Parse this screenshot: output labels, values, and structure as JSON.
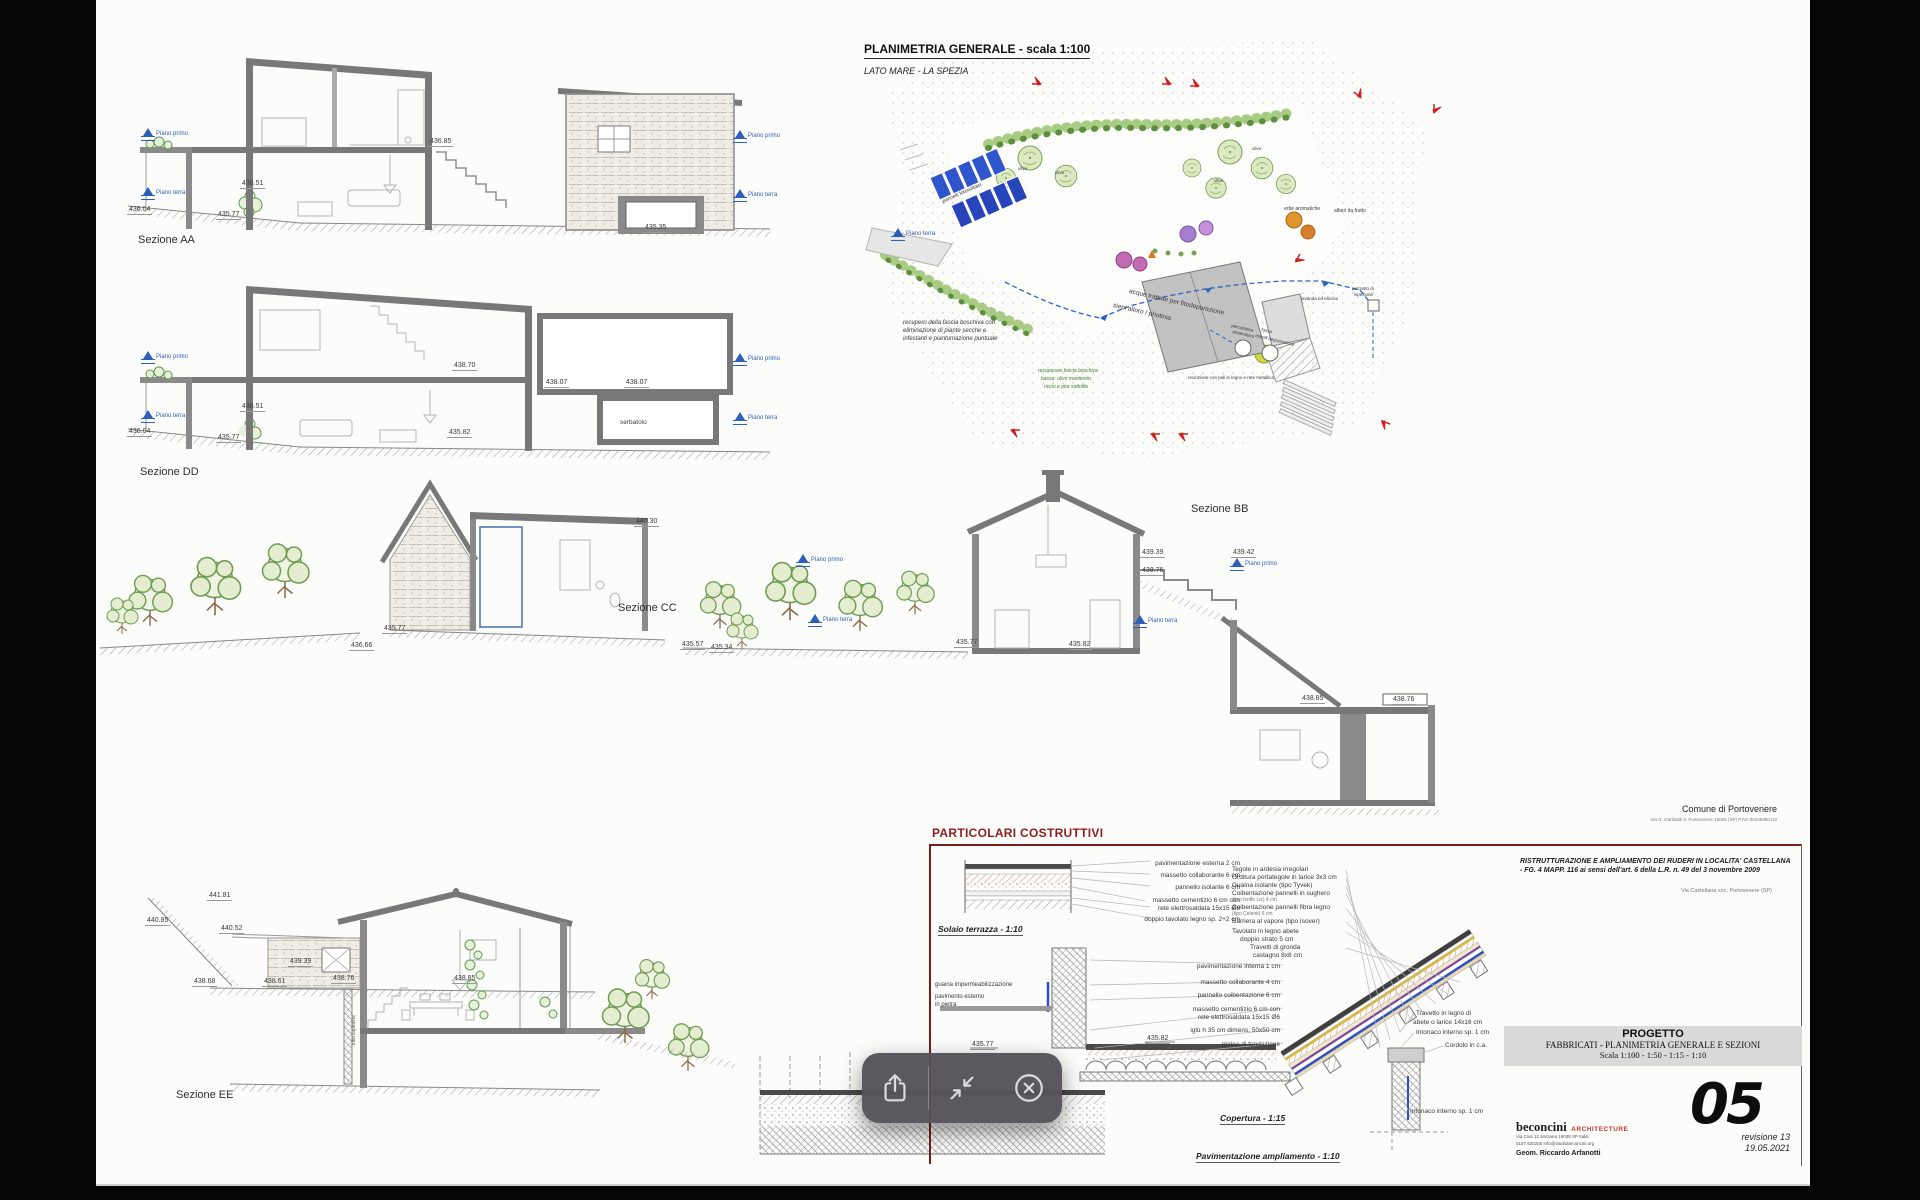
{
  "plan": {
    "title": "PLANIMETRIA GENERALE - scala 1:100",
    "subtitle": "LATO MARE - LA SPEZIA",
    "pannelli": "pannelli fotovoltaici",
    "acque": "acque trattate per fitodepurazione",
    "siepi": "siepi alloro / photinia",
    "ulivo": "ulivo",
    "lavanda": "lavanda ed elicriso",
    "erbe": "erbe aromatiche",
    "alberi": "alberi da frutto",
    "pozzetto1": "pozzetto di",
    "pozzetto2": "ispezione",
    "percolatore1": "percolatore",
    "percolatore2": "anaerobico",
    "fossa1": "fossa",
    "fossa2": "imhoff degrassatore",
    "recupero1": "recupero della fascia boschiva con",
    "recupero2": "eliminazione di piante secche e",
    "recupero3": "infestanti e piantumazione puntuale",
    "recuperare1": "recuperare fascia boschiva",
    "recuperare2": "bassa: ulivo mantenim.",
    "recuperare3": "riccio e pira sottofile",
    "recinzione": "recinzione con pali in legno e rete metallica"
  },
  "common": {
    "piano_primo": "Piano primo",
    "piano_terra": "Piano terra"
  },
  "aa": {
    "label": "Sezione AA",
    "e1": "436.85",
    "e2": "436.51",
    "e3": "436.04",
    "e4": "435.77",
    "e5": "435.35"
  },
  "dd": {
    "label": "Sezione DD",
    "e1": "438.70",
    "e2": "438.07",
    "e3": "438.07",
    "e4": "436.51",
    "e5": "436.04",
    "e6": "435.77",
    "e7": "435.82",
    "serbatoio": "serbatoio"
  },
  "cc": {
    "label": "Sezione CC",
    "e1": "440.30",
    "e2": "435.77",
    "e3": "436.66"
  },
  "bb": {
    "label": "Sezione BB",
    "e1": "439.39",
    "e2": "439.42",
    "e3": "438.76",
    "e4": "435.57",
    "e5": "435.34",
    "e6": "435.77",
    "e7": "435.82",
    "e8": "438.85",
    "e9": "438.76"
  },
  "ee": {
    "label": "Sezione EE",
    "e1": "441.81",
    "e2": "440.85",
    "e3": "440.52",
    "e4": "439.39",
    "e5": "438.68",
    "e6": "438.61",
    "e7": "438.76",
    "e8": "438.85",
    "intercapedine": "Intercapedine"
  },
  "details": {
    "title": "PARTICOLARI COSTRUTTIVI",
    "solaio_caption": "Solaio terrazza - 1:10",
    "s1": "pavimentazione esterna 2 cm",
    "s2": "massetto collaborante 6 cm",
    "s3": "pannello isolante 6 cm",
    "s4": "massetto cementizio 6 cm con",
    "s5": "rete elettrosaldata 15x15 Ø6",
    "s6": "doppio tavolato legno sp. 2+2 cm",
    "f1": "pavimentazione interna 1 cm",
    "f2": "massetto collaborante 4 cm",
    "f3": "pannello coibentazione 6 cm",
    "f4": "massetto cementizio 6 cm con",
    "f5": "rete elettrosaldata 15x15 Ø6",
    "f6": "iglù h 35 cm dimens. 50x50 cm",
    "f7": "platea di fondazione",
    "guaina": "guaina impermeabilizzazione",
    "pav1": "pavimento esterno",
    "pav2": "in pietra",
    "fe1": "435.82",
    "fe2": "435.77",
    "pav_caption": "Pavimentazione ampliamento - 1:10",
    "c1": "Tegole in ardesia irregolari",
    "c2": "Orditura portategole in larice 3x3 cm",
    "c3": "Guaina isolante (tipo Tyvek)",
    "c4": "Coibentazione pannelli in sughero",
    "c4b": "(tipo Isolfe Lis) 4 cm",
    "c5": "Coibentazione pannelli fibra legno",
    "c5b": "(tipo Celenit) 6 cm",
    "c6": "Barriera al vapore (tipo Isover)",
    "c7": "Tavolato in legno abete",
    "c7b": "doppio strato 5 cm",
    "c8": "Travetti di gronda",
    "c8b": "castagno 8x8 cm",
    "cop_caption": "Copertura - 1:15",
    "t1": "Travetto in legno di",
    "t2": "abete o larice 14x16 cm",
    "t3": "Intonaco interno sp. 1 cm",
    "t4": "Cordolo in c.a.",
    "t5": "Intonaco interno sp. 1 cm"
  },
  "block": {
    "comune": "Comune di Portovenere",
    "comune_sub": "Via G. Garibaldi 9, Portovenere 19025 (SP)  P.IVA 00235390119",
    "ristr1": "RISTRUTTURAZIONE E AMPLIAMENTO DEI RUDERI IN LOCALITA' CASTELLANA",
    "ristr2": "- FG. 4 MAPP. 116 ai sensi dell'art. 6 della L.R. n. 49 del 3 novembre 2009",
    "via": "Via Castellana snc, Portovenere (SP)",
    "progetto": "PROGETTO",
    "progetto_sub": "FABBRICATI - PLANIMETRIA GENERALE E SEZIONI",
    "progetto_scala": "Scala 1:100 - 1:50 - 1:15 - 1:10",
    "num": "05",
    "rev": "revisione 13",
    "date": "19.05.2021",
    "studio": "beconcini",
    "studio_type": "ARCHITECTURE",
    "addr1": "Via Civa 12 Sarzana 19038 SP Italia",
    "addr2": "0187.620255  info@studiobeconcini.org",
    "geom": "Geom. Riccardo Arfanotti"
  }
}
